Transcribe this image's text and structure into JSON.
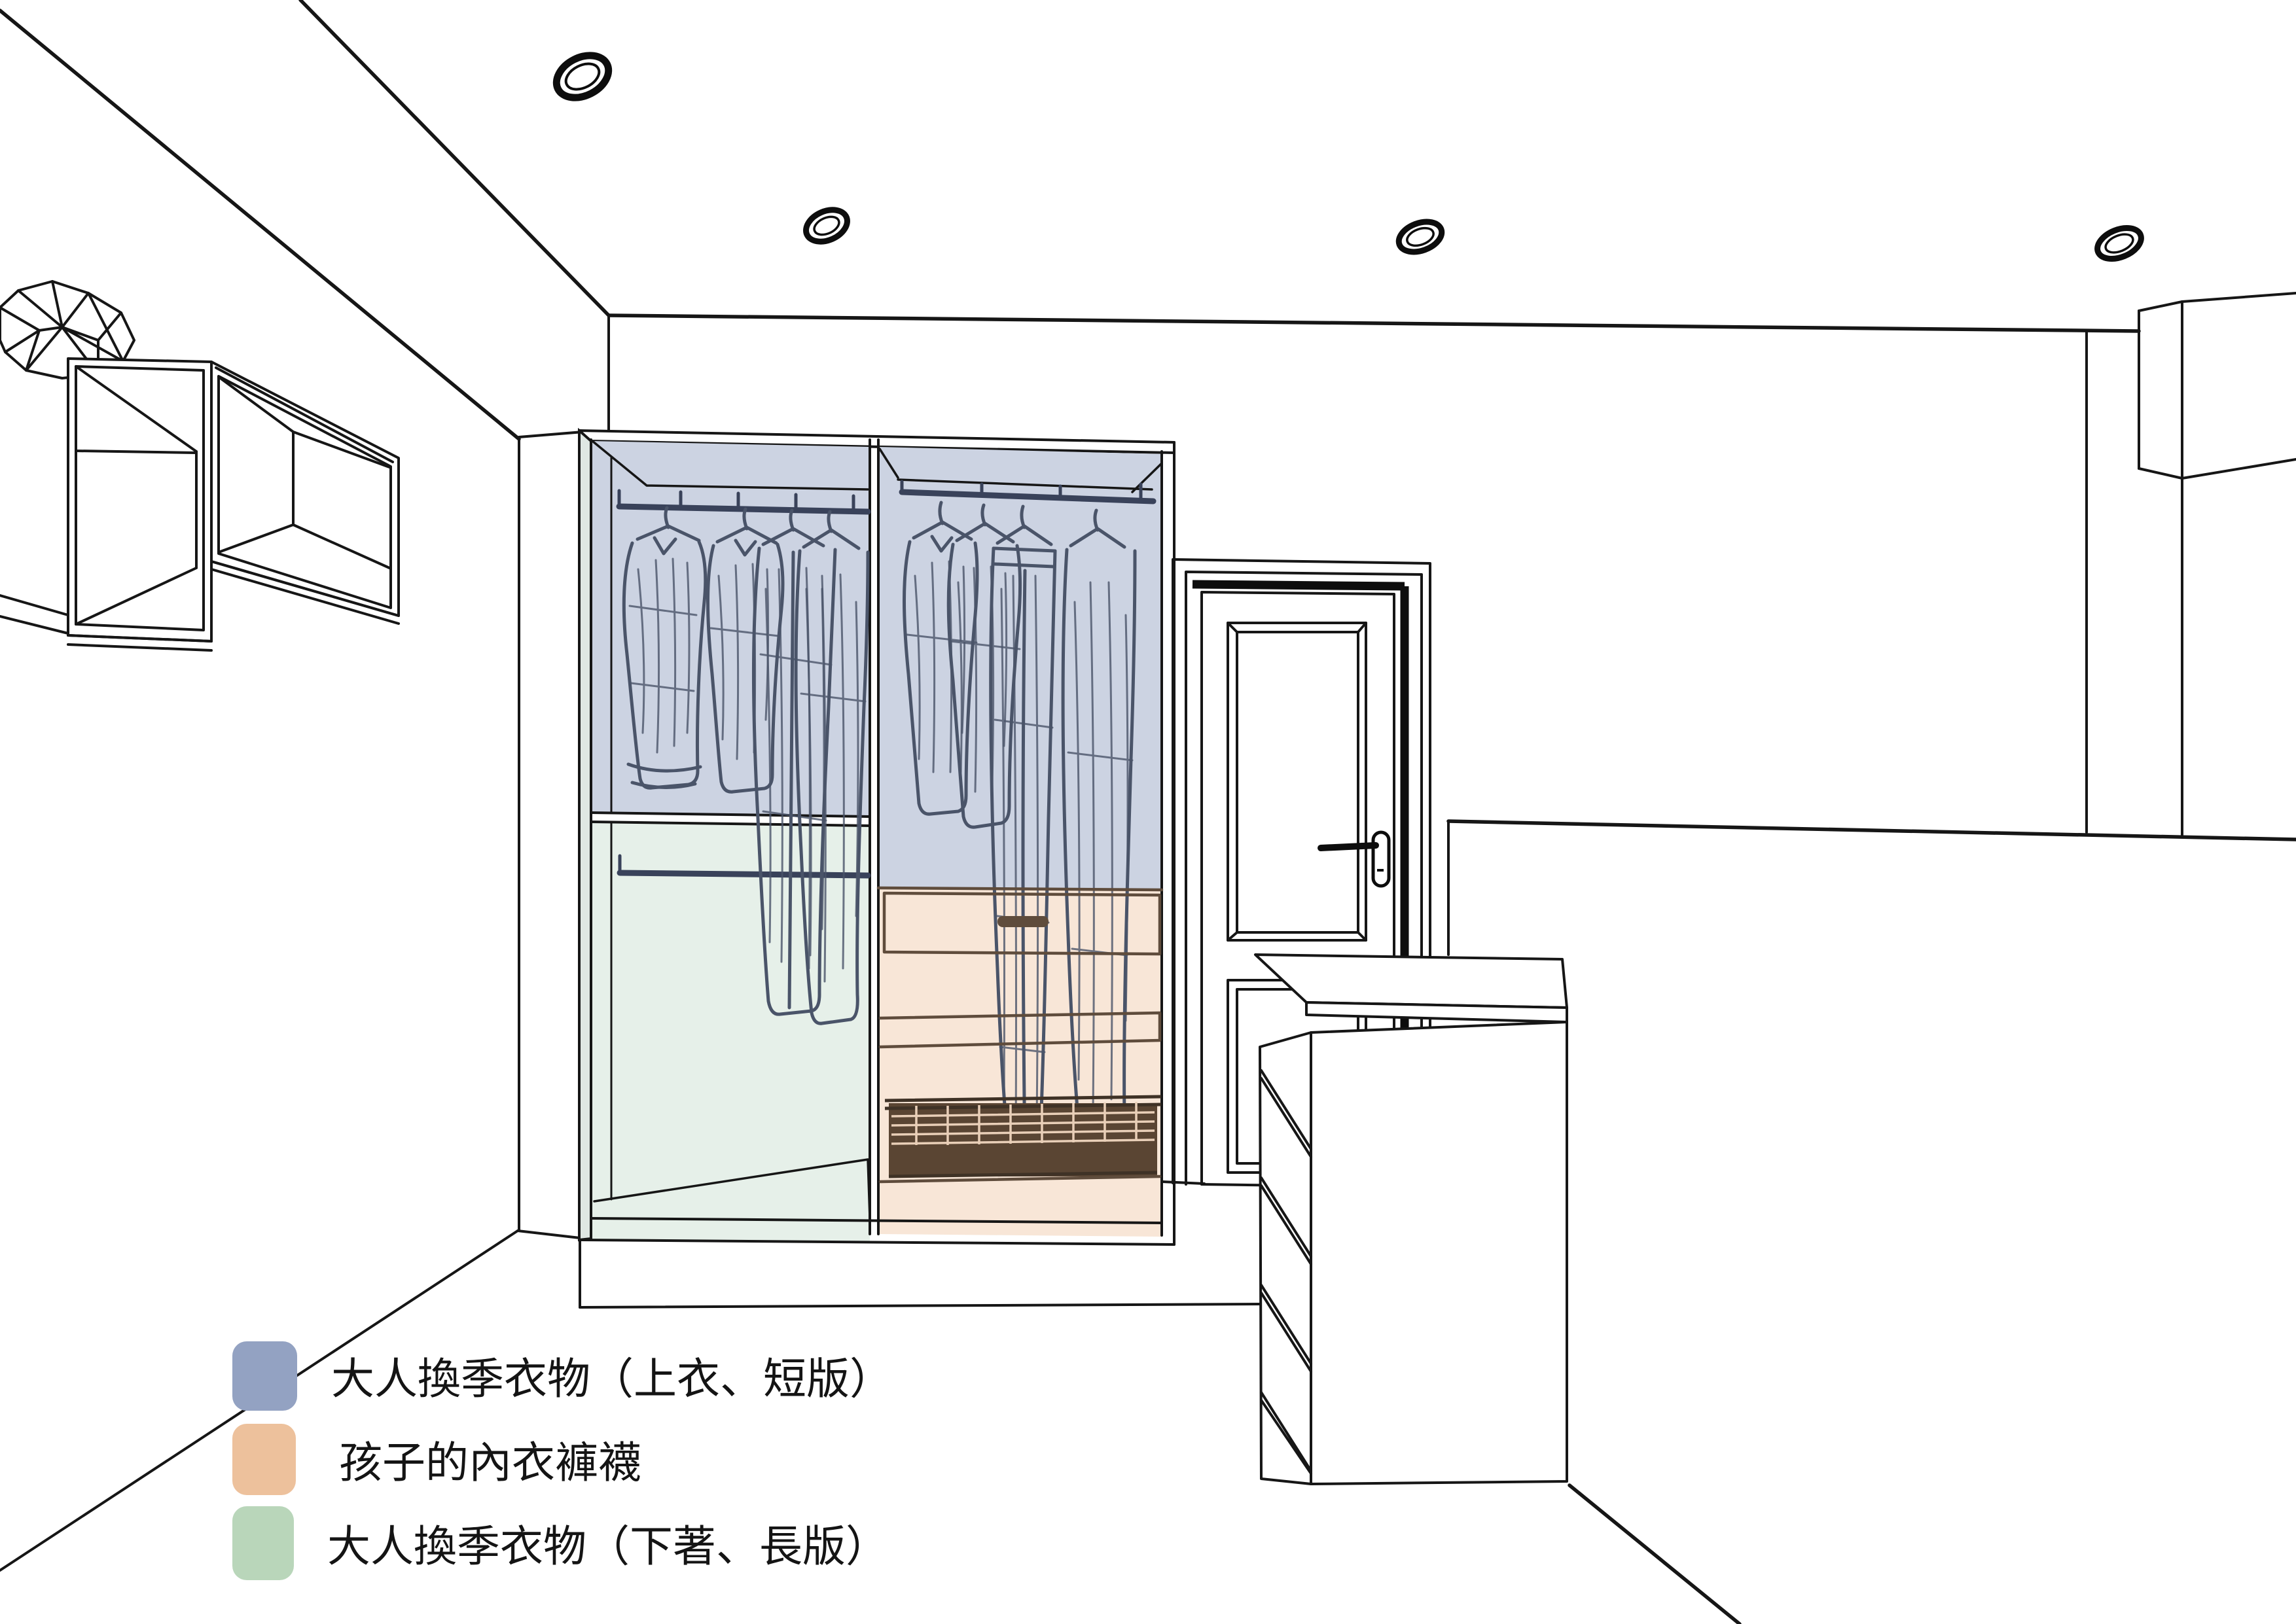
{
  "legend": {
    "items": [
      {
        "label": "大人換季衣物（上衣、短版）",
        "color": "#93a2c2"
      },
      {
        "label": "孩子的內衣褲襪",
        "color": "#edc19c"
      },
      {
        "label": "大人換季衣物（下著、長版）",
        "color": "#b9d6ba"
      }
    ]
  },
  "zones": {
    "adult_tops_blue": "#ccd3e2",
    "adult_bottoms_green": "#e6f0e9",
    "kids_underwear_peach": "#f8e6d7",
    "side_panel_tint": "#dfe7e3"
  },
  "palette": {
    "outline": "#161616",
    "clothes_sketch": "#4a5469",
    "cabinet_wood_line": "#5f4c3c",
    "wire_basket_fill": "#5a4533",
    "rod": "#39425a"
  }
}
